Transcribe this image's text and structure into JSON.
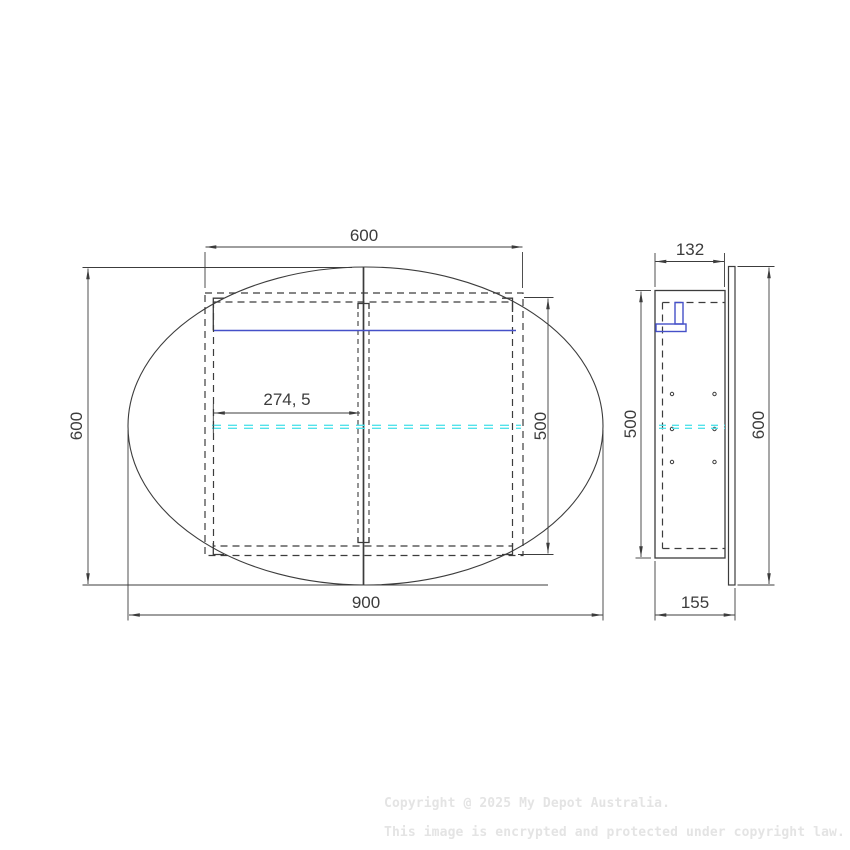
{
  "front_view": {
    "dims": {
      "opening_width": "600",
      "overall_height": "600",
      "cabinet_height": "500",
      "overall_width": "900",
      "shelf_offset": "274, 5"
    }
  },
  "side_view": {
    "dims": {
      "cabinet_depth": "132",
      "cabinet_height": "500",
      "door_height": "600",
      "overall_depth": "155"
    }
  },
  "watermark": {
    "line1": "Copyright @ 2025 My Depot Australia.",
    "line2": "This image is encrypted and protected under copyright law."
  },
  "colors": {
    "line": "#3c3c3c",
    "shelf_highlight": "#4550c8",
    "centerline_cyan": "#52e2ea",
    "watermark_gray": "#e4e4e4"
  }
}
